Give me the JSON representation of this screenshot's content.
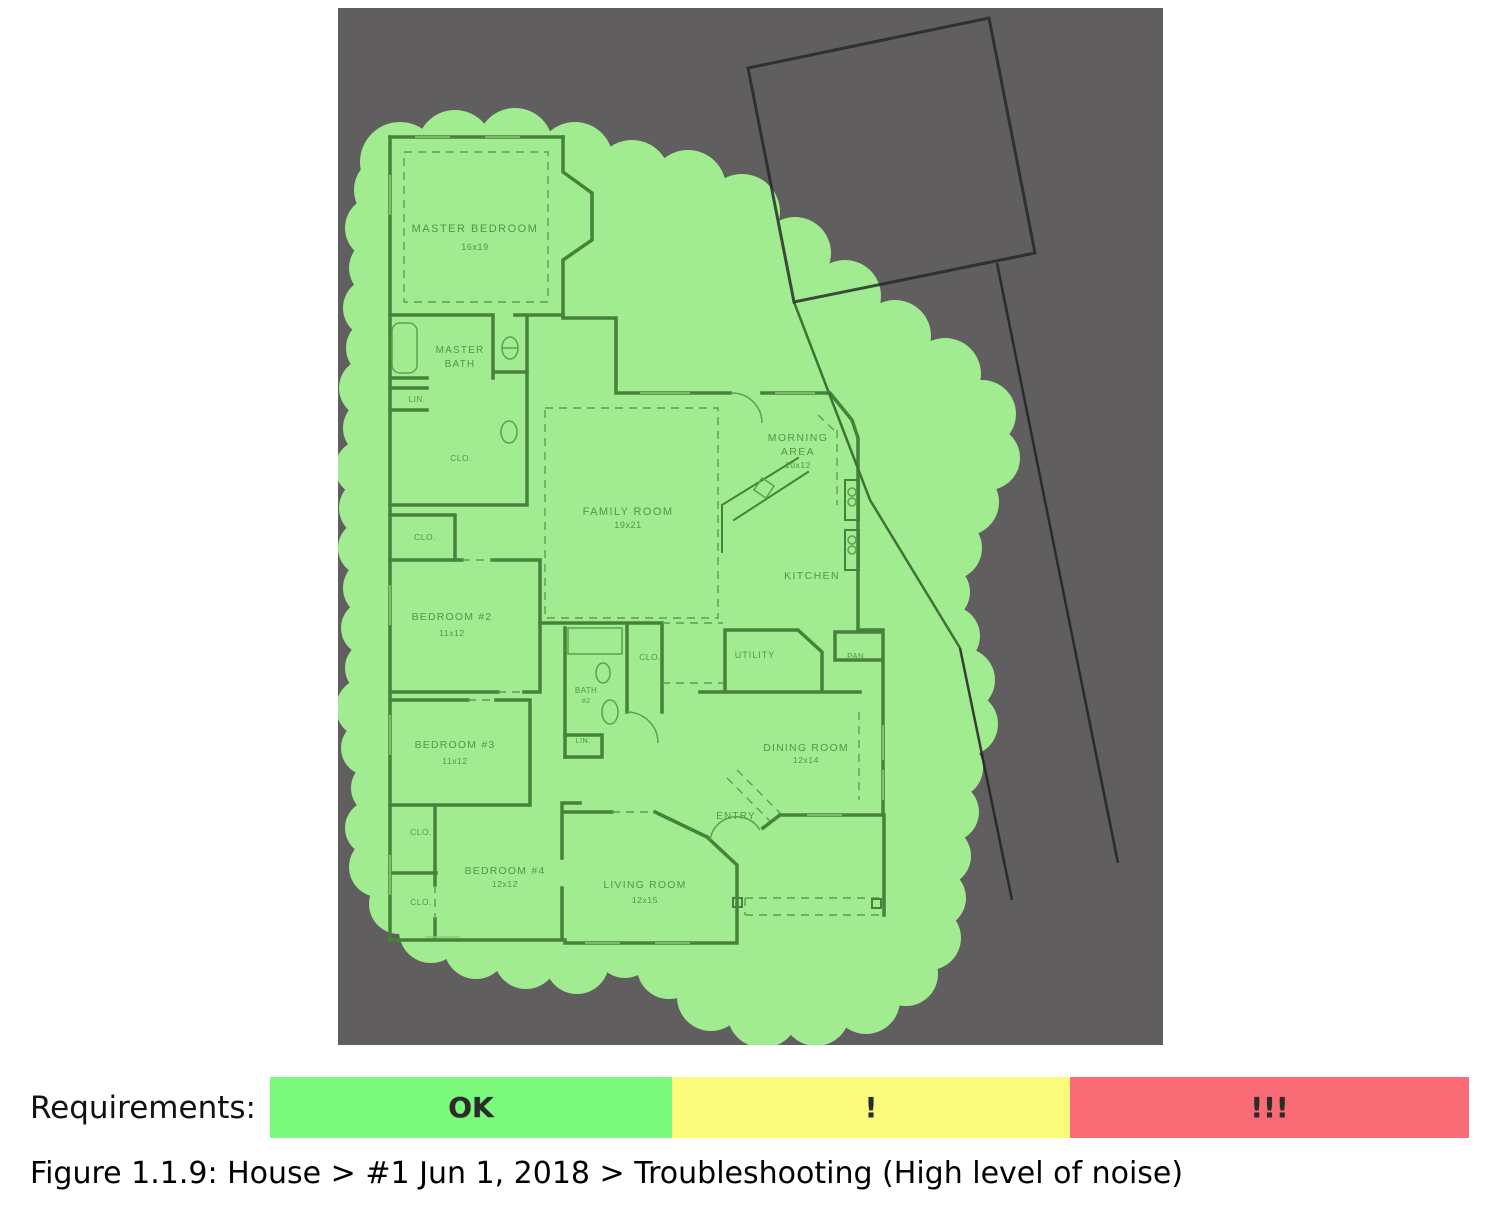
{
  "floorplan": {
    "background_color": "#605E5E",
    "coverage_color": "#A1EB90",
    "wall_color": "#47823A",
    "label_color": "#579549",
    "labels": [
      {
        "text": "MASTER  BEDROOM",
        "x": 475,
        "y": 232,
        "size": 11,
        "ls": 1.5
      },
      {
        "text": "16x19",
        "x": 475,
        "y": 250,
        "size": 9,
        "ls": 0.6
      },
      {
        "text": "MASTER",
        "x": 460,
        "y": 353,
        "size": 10,
        "ls": 1.2
      },
      {
        "text": "BATH",
        "x": 460,
        "y": 367,
        "size": 10,
        "ls": 1.2
      },
      {
        "text": "LIN.",
        "x": 417,
        "y": 402,
        "size": 8,
        "ls": 0.5
      },
      {
        "text": "CLO.",
        "x": 461,
        "y": 461,
        "size": 8.5,
        "ls": 0.5
      },
      {
        "text": "CLO.",
        "x": 425,
        "y": 540,
        "size": 8.5,
        "ls": 0.5
      },
      {
        "text": "MORNING",
        "x": 798,
        "y": 441,
        "size": 10.5,
        "ls": 1.4
      },
      {
        "text": "AREA",
        "x": 798,
        "y": 455,
        "size": 10.5,
        "ls": 1.4
      },
      {
        "text": "10x12",
        "x": 798,
        "y": 468,
        "size": 8.5,
        "ls": 0.6
      },
      {
        "text": "FAMILY  ROOM",
        "x": 628,
        "y": 515,
        "size": 11,
        "ls": 1.4
      },
      {
        "text": "19x21",
        "x": 628,
        "y": 528,
        "size": 9,
        "ls": 0.6
      },
      {
        "text": "KITCHEN",
        "x": 812,
        "y": 579,
        "size": 10.5,
        "ls": 1.4
      },
      {
        "text": "BEDROOM  #2",
        "x": 452,
        "y": 620,
        "size": 10.5,
        "ls": 1.2
      },
      {
        "text": "11x12",
        "x": 452,
        "y": 636,
        "size": 8.5,
        "ls": 0.6
      },
      {
        "text": "CLO.",
        "x": 650,
        "y": 660,
        "size": 8.5,
        "ls": 0.5
      },
      {
        "text": "UTILITY",
        "x": 755,
        "y": 658,
        "size": 9,
        "ls": 1
      },
      {
        "text": "PAN.",
        "x": 857,
        "y": 659,
        "size": 8,
        "ls": 0.4
      },
      {
        "text": "BATH",
        "x": 586,
        "y": 693,
        "size": 8,
        "ls": 0.4
      },
      {
        "text": "#2",
        "x": 586,
        "y": 703,
        "size": 7.5,
        "ls": 0.3
      },
      {
        "text": "LIN.",
        "x": 583,
        "y": 743,
        "size": 7.5,
        "ls": 0.3
      },
      {
        "text": "BEDROOM  #3",
        "x": 455,
        "y": 748,
        "size": 10.5,
        "ls": 1.2
      },
      {
        "text": "11x12",
        "x": 455,
        "y": 764,
        "size": 8.5,
        "ls": 0.6
      },
      {
        "text": "DINING  ROOM",
        "x": 806,
        "y": 751,
        "size": 10.5,
        "ls": 1.2
      },
      {
        "text": "12x14",
        "x": 806,
        "y": 763,
        "size": 8.5,
        "ls": 0.6
      },
      {
        "text": "CLO.",
        "x": 421,
        "y": 835,
        "size": 8.5,
        "ls": 0.5
      },
      {
        "text": "ENTRY",
        "x": 736,
        "y": 819,
        "size": 10,
        "ls": 1.2
      },
      {
        "text": "BEDROOM  #4",
        "x": 505,
        "y": 874,
        "size": 10.5,
        "ls": 1.2
      },
      {
        "text": "12x12",
        "x": 505,
        "y": 887,
        "size": 8.5,
        "ls": 0.6
      },
      {
        "text": "CLO.",
        "x": 421,
        "y": 905,
        "size": 8.5,
        "ls": 0.5
      },
      {
        "text": "LIVING  ROOM",
        "x": 645,
        "y": 888,
        "size": 10.5,
        "ls": 1.2
      },
      {
        "text": "12x15",
        "x": 645,
        "y": 903,
        "size": 8.5,
        "ls": 0.6
      }
    ]
  },
  "legend": {
    "label": "Requirements:",
    "items": [
      {
        "label": "OK",
        "color": "#7CFA7C",
        "width": 402
      },
      {
        "label": "!",
        "color": "#FAFA7C",
        "width": 398
      },
      {
        "label": "!!!",
        "color": "#FA6C75",
        "width": 399
      }
    ]
  },
  "caption": "Figure 1.1.9: House > #1 Jun 1, 2018 > Troubleshooting (High level of noise)"
}
